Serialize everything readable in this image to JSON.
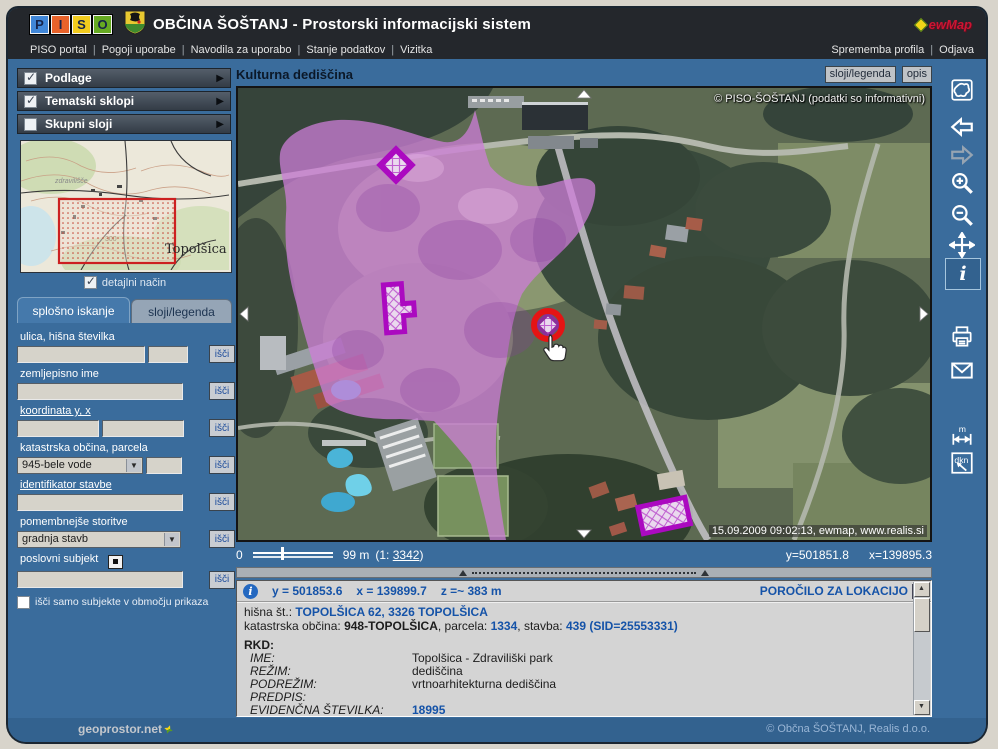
{
  "colors": {
    "heritage": "#ce7ed8",
    "heritage_border": "#ab0ac0",
    "selected_ring": "#e41414",
    "link": "#1a56a8"
  },
  "header": {
    "logo": [
      "P",
      "I",
      "S",
      "O"
    ],
    "title": "OBČINA ŠOŠTANJ - Prostorski informacijski sistem",
    "ewmap": "ewMap",
    "menu": [
      "PISO portal",
      "Pogoji uporabe",
      "Navodila za uporabo",
      "Stanje podatkov",
      "Vizitka"
    ],
    "menu_right": [
      "Sprememba profila",
      "Odjava"
    ]
  },
  "sidebar": {
    "accordions": [
      {
        "label": "Podlage",
        "checked": true
      },
      {
        "label": "Tematski sklopi",
        "checked": true
      },
      {
        "label": "Skupni sloji",
        "checked": false
      }
    ],
    "overview": {
      "place": "Topolšica",
      "spa": "zdravilišče",
      "elevation": "300",
      "detail": "detajlni način"
    },
    "tabs": [
      {
        "label": "splošno iskanje"
      },
      {
        "label": "sloji/legenda"
      }
    ],
    "find": "išči",
    "fields": [
      {
        "label": "ulica, hišna številka"
      },
      {
        "label": "zemljepisno ime"
      },
      {
        "label": "koordinata y, x"
      },
      {
        "label": "katastrska občina, parcela",
        "value": "945-bele vode"
      },
      {
        "label": "identifikator stavbe"
      },
      {
        "label": "pomembnejše storitve",
        "value": "gradnja stavb"
      },
      {
        "label": "poslovni subjekt"
      }
    ],
    "area_checkbox": "išči samo subjekte v območju prikaza"
  },
  "map": {
    "title": "Kulturna dediščina",
    "buttons": [
      "sloji/legenda",
      "opis"
    ],
    "watermark": "© PISO-ŠOŠTANJ (podatki so informativni)",
    "timestamp": "15.09.2009 09:02:13, ewmap, www.realis.si",
    "scale": {
      "zero": "0",
      "distance": "99 m",
      "ratio_open": "(1:",
      "ratio": "3342",
      "ratio_close": ")"
    },
    "coord_y": "y=501851.8",
    "coord_x": "x=139895.3"
  },
  "info": {
    "coord_y": "y = 501853.6",
    "coord_x": "x = 139899.7",
    "coord_z": "z =~ 383 m",
    "report": "POROČILO ZA LOKACIJO",
    "house_label": "hišna št.:",
    "house_value": "TOPOLŠICA 62, 3326 TOPOLŠICA",
    "cad_label": "katastrska občina:",
    "cad_value": "948-TOPOLŠICA",
    "parcel_label": ", parcela:",
    "parcel_value": "1334",
    "building_label": ", stavba:",
    "building_value": "439 (SID=25553331)",
    "rkd": "RKD:",
    "rkd_rows": [
      {
        "label": "IME:",
        "value": "Topolšica - Zdraviliški park"
      },
      {
        "label": "REŽIM:",
        "value": "dediščina"
      },
      {
        "label": "PODREŽIM:",
        "value": "vrtnoarhitekturna dediščina"
      },
      {
        "label": "PREDPIS:",
        "value": ""
      },
      {
        "label": "EVIDENČNA ŠTEVILKA:",
        "value": "18995"
      },
      {
        "label": "TIP:",
        "value": "vrtnoarhitekturna dediščina"
      }
    ]
  },
  "toolbar": {
    "info_glyph": "i",
    "measure_glyph": "m",
    "dkn_glyph": "dkn"
  },
  "footer": {
    "brand": "geoprostor.net",
    "copyright": "© Občna ŠOŠTANJ, Realis d.o.o."
  }
}
